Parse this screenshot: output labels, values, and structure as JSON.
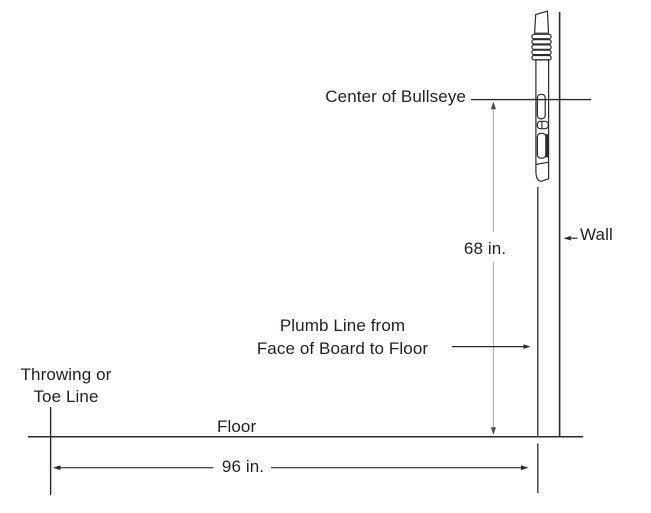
{
  "diagram": {
    "labels": {
      "center_of_bullseye": "Center of Bullseye",
      "bullseye_height": "68 in.",
      "wall": "Wall",
      "plumb_line_1": "Plumb Line from",
      "plumb_line_2": "Face of Board to Floor",
      "throw_line_1": "Throwing or",
      "throw_line_2": "Toe Line",
      "floor": "Floor",
      "throw_distance": "96 in."
    },
    "measurements": {
      "bullseye_center_height": "68 in.",
      "toe_line_to_plumb_line": "96 in."
    },
    "colors": {
      "background": "#ffffff",
      "line": "#2b2b2b",
      "dimension_line": "#b0b0b0",
      "arrowhead": "#4d4d4d",
      "text": "#231f20"
    }
  }
}
